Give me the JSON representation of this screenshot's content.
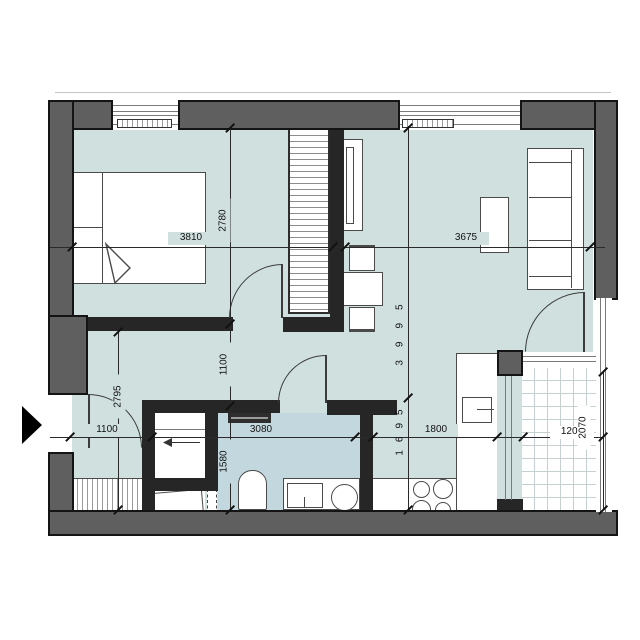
{
  "document": {
    "type": "apartment-floor-plan"
  },
  "colors": {
    "floor": "#cfe0df",
    "bathroom_floor": "#c3d8de",
    "exterior_wall": "#5f5f5f",
    "interior_wall": "#262626",
    "dimension_text": "#111111"
  },
  "dimensions_mm": {
    "bedroom_width": "3810",
    "bedroom_depth": "2780",
    "living_room_width": "3675",
    "living_zone_depth": "3995",
    "kitchen_zone_depth": "1695",
    "hallway_depth": "2795",
    "entry_width": "1100",
    "hallway_passage": "1100",
    "bathroom_width": "3080",
    "bathroom_depth": "1580",
    "kitchen_run_width": "1800",
    "balcony_width": "1208",
    "balcony_depth": "2070"
  }
}
